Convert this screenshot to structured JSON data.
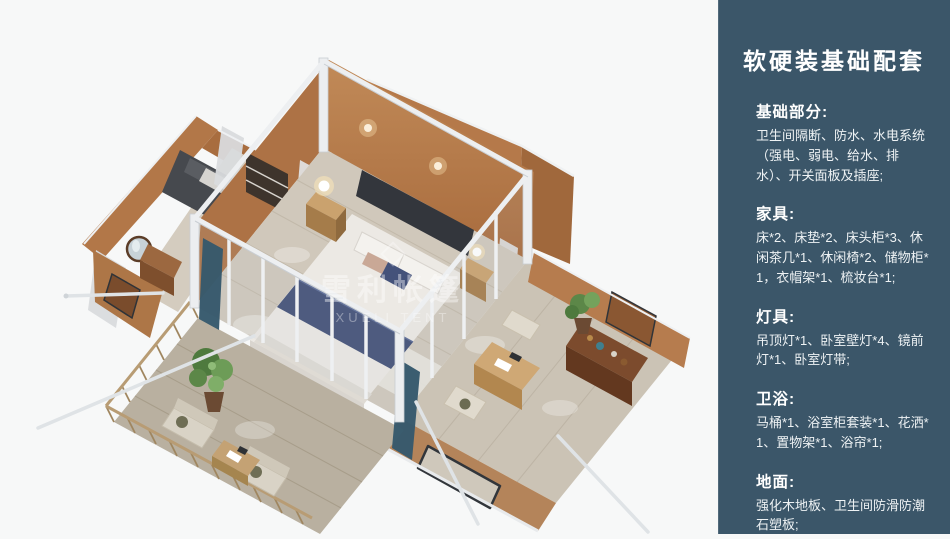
{
  "panel": {
    "title": "软硬装基础配套",
    "background_color": "#3b5669",
    "text_color": "#ffffff",
    "sections": [
      {
        "heading": "基础部分:",
        "body": "卫生间隔断、防水、水电系统（强电、弱电、给水、排水）、开关面板及插座;"
      },
      {
        "heading": "家具:",
        "body": "床*2、床垫*2、床头柜*3、休闲茶几*1、休闲椅*2、储物柜*1，衣帽架*1、梳妆台*1;"
      },
      {
        "heading": "灯具:",
        "body": "吊顶灯*1、卧室壁灯*4、镜前灯*1、卧室灯带;"
      },
      {
        "heading": "卫浴:",
        "body": "马桶*1、浴室柜套装*1、花洒*1、置物架*1、浴帘*1;"
      },
      {
        "heading": "地面:",
        "body": "强化木地板、卫生间防滑防潮石塑板;"
      }
    ]
  },
  "render": {
    "watermark_line1": "雪利帐篷",
    "watermark_line2": "XUELI TENT",
    "colors": {
      "wall_terracotta": "#b97c4e",
      "wall_shadow": "#9c6136",
      "floor_wood": "#cfc8bb",
      "deck_wood": "#b9b0a0",
      "frame_white": "#eceef0",
      "bedding_white": "#ece9e4",
      "runner_navy": "#3f4d75",
      "curtain_teal": "#36596c",
      "plant_green": "#5c8748",
      "background": "#f7f8f8"
    }
  }
}
